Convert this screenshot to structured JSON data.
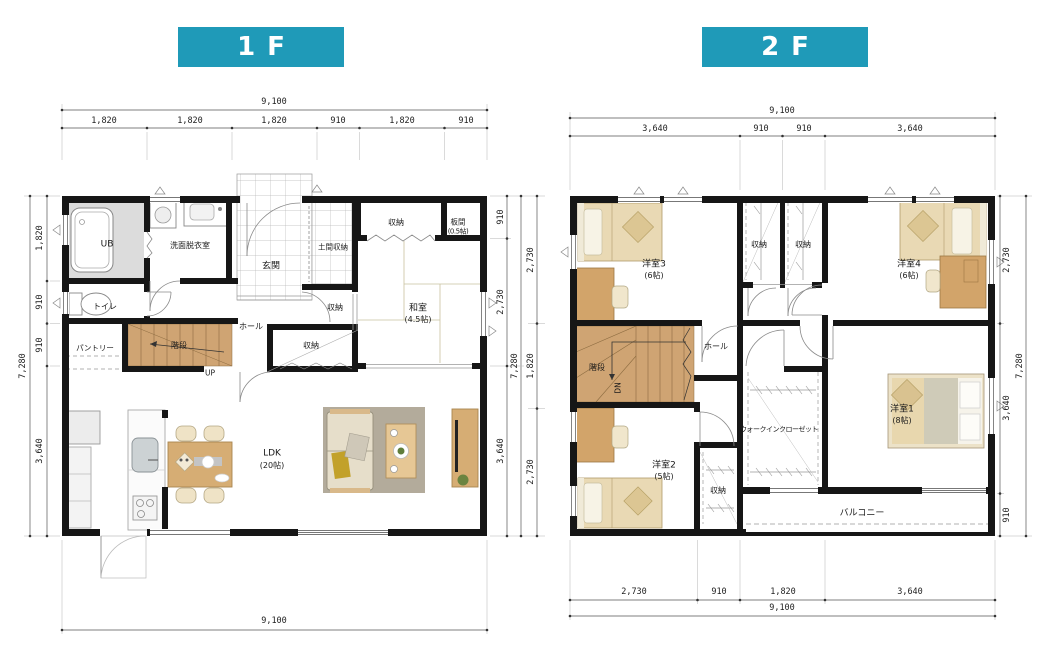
{
  "colors": {
    "banner": "#1f9ab8",
    "wall": "#161616",
    "stairs_fill": "#cfa473",
    "wood_furniture": "#d2a46a",
    "bed_tan": "#e9d9b4",
    "rug_gray": "#b3ab9b"
  },
  "f1": {
    "title": "1F",
    "labels": {
      "ub": "UB",
      "washroom": "洗面脱衣室",
      "entrance": "玄関",
      "doma_storage": "土間収納",
      "storage_top": "収納",
      "itanoma": "板間",
      "itanoma_size": "(0.5帖)",
      "washitsu": "和室",
      "washitsu_size": "(4.5帖)",
      "storage_mid": "収納",
      "storage_low": "収納",
      "toilet": "トイレ",
      "hall": "ホール",
      "pantry": "パントリー",
      "stairs": "階段",
      "up": "UP",
      "ldk": "LDK",
      "ldk_size": "(20帖)"
    },
    "dims": {
      "top_total": "9,100",
      "top": [
        "1,820",
        "1,820",
        "1,820",
        "910",
        "1,820",
        "910"
      ],
      "left_total": "7,280",
      "left": [
        "1,820",
        "910",
        "910",
        "3,640"
      ],
      "right": [
        "910",
        "2,730",
        "3,640"
      ],
      "right_total": "7,280",
      "bottom_total": "9,100"
    }
  },
  "f2": {
    "title": "2F",
    "labels": {
      "room3": "洋室3",
      "room3_size": "(6帖)",
      "storage_a": "収納",
      "storage_b": "収納",
      "room4": "洋室4",
      "room4_size": "(6帖)",
      "stairs": "階段",
      "dn": "DN",
      "hall": "ホール",
      "room2": "洋室2",
      "room2_size": "(5帖)",
      "storage_c": "収納",
      "wic": "ウォークインクローゼット",
      "room1": "洋室1",
      "room1_size": "(8帖)",
      "balcony": "バルコニー"
    },
    "dims": {
      "top_total": "9,100",
      "top": [
        "3,640",
        "910",
        "910",
        "3,640"
      ],
      "left": [
        "2,730",
        "1,820",
        "2,730"
      ],
      "right": [
        "2,730",
        "3,640",
        "910"
      ],
      "right_total": "7,280",
      "bottom": [
        "2,730",
        "910",
        "1,820",
        "3,640"
      ],
      "bottom_total": "9,100"
    }
  }
}
